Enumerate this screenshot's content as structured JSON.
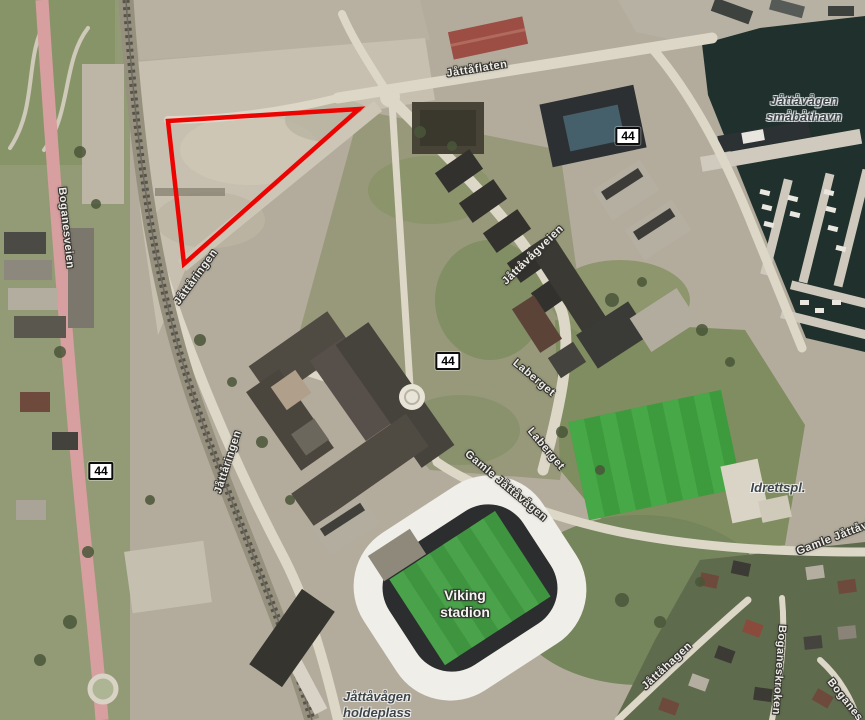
{
  "map": {
    "highlight": {
      "color": "#ec0402",
      "points": "168,121 359,109 184,264"
    },
    "labels": [
      {
        "name": "road-label-jattaflaten",
        "text": "Jåttåflaten",
        "x": 477,
        "y": 69,
        "rot": -9,
        "kind": "road"
      },
      {
        "name": "place-label-smabathavn",
        "lines": [
          "Jåttåvågen",
          "småbåthavn"
        ],
        "x": 804,
        "y": 109,
        "rot": 0,
        "kind": "place"
      },
      {
        "name": "road-label-boganesveien",
        "text": "Boganesveien",
        "x": 66,
        "y": 228,
        "rot": 84,
        "kind": "road"
      },
      {
        "name": "road-label-jattaringen-north",
        "text": "Jåttåringen",
        "x": 196,
        "y": 277,
        "rot": -54,
        "kind": "road"
      },
      {
        "name": "road-label-jattaringen-south",
        "text": "Jåttåringen",
        "x": 228,
        "y": 462,
        "rot": -72,
        "kind": "road"
      },
      {
        "name": "road-label-jattavagveien",
        "text": "Jåttåvågveien",
        "x": 533,
        "y": 255,
        "rot": -44,
        "kind": "road"
      },
      {
        "name": "road-label-laberget-north",
        "text": "Laberget",
        "x": 534,
        "y": 378,
        "rot": 40,
        "kind": "road"
      },
      {
        "name": "road-label-laberget-south",
        "text": "Laberget",
        "x": 546,
        "y": 449,
        "rot": 50,
        "kind": "road"
      },
      {
        "name": "road-label-gamle-jattavagen",
        "text": "Gamle Jåttåvågen",
        "x": 506,
        "y": 486,
        "rot": 40,
        "kind": "road"
      },
      {
        "name": "stadium-label",
        "lines": [
          "Viking",
          "stadion"
        ],
        "x": 465,
        "y": 604,
        "rot": 0,
        "kind": "stadium"
      },
      {
        "name": "place-label-idrettspl",
        "text": "Idrettspl.",
        "x": 778,
        "y": 488,
        "rot": 0,
        "kind": "place"
      },
      {
        "name": "road-label-gamle-jatta-east",
        "text": "Gamle Jåttåvågen",
        "x": 797,
        "y": 552,
        "rot": -21,
        "kind": "road",
        "anchor": "left"
      },
      {
        "name": "road-label-jattahagen",
        "text": "Jåttåhagen",
        "x": 667,
        "y": 666,
        "rot": -43,
        "kind": "road"
      },
      {
        "name": "road-label-boganeskroken",
        "text": "Boganeskroken",
        "x": 779,
        "y": 670,
        "rot": 94,
        "kind": "road"
      },
      {
        "name": "road-label-boganes-corner",
        "text": "Boganes",
        "x": 845,
        "y": 700,
        "rot": 52,
        "kind": "road"
      },
      {
        "name": "place-label-holdeplass",
        "lines": [
          "Jåttåvågen",
          "holdeplass"
        ],
        "x": 377,
        "y": 705,
        "rot": 0,
        "kind": "place"
      }
    ],
    "road_badges": [
      {
        "value": "44",
        "x": 628,
        "y": 136
      },
      {
        "value": "44",
        "x": 101,
        "y": 471
      },
      {
        "value": "44",
        "x": 448,
        "y": 361
      }
    ]
  }
}
